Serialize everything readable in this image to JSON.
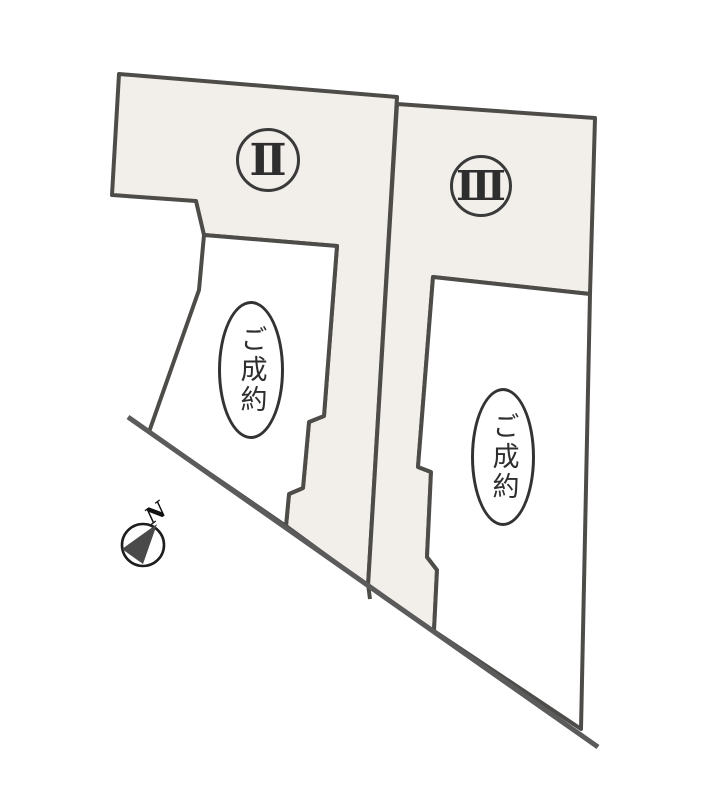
{
  "plan": {
    "kind": "land-lot-site-plan"
  },
  "lots": {
    "lot2": {
      "numeral": "Ⅱ",
      "status": "ご成約"
    },
    "lot3": {
      "numeral": "Ⅲ",
      "status": "ご成約"
    }
  },
  "compass": {
    "label": "N"
  },
  "colors": {
    "parcel_fill": "#f2efeb",
    "sold_fill": "#ffffff",
    "line": "#4e4c49",
    "road": "#5b5b5b",
    "badge_border": "#3a3a3a",
    "text": "#2e2e2e",
    "needle": "#4a4a4a",
    "compass_ring": "#1d1d1d"
  }
}
